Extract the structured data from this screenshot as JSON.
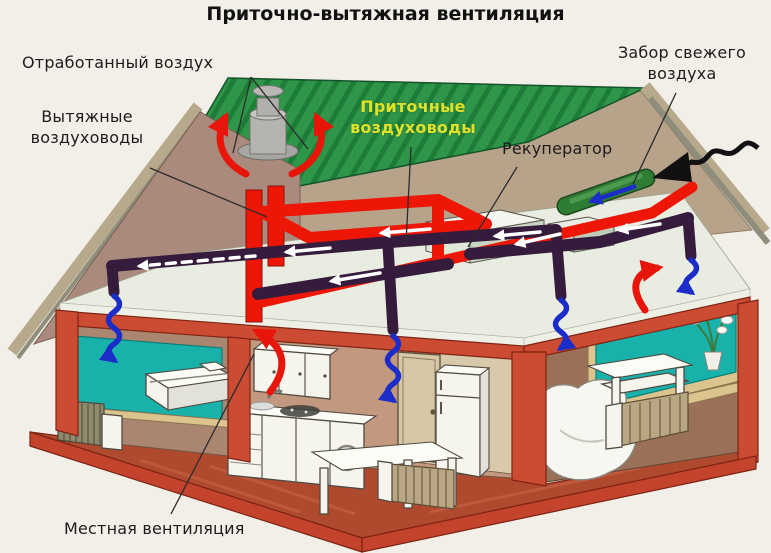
{
  "title": "Приточно-вытяжная вентиляция",
  "labels": {
    "exhaust_air": "Отработанный воздух",
    "exhaust_ducts": "Вытяжные воздуховоды",
    "supply_ducts": "Приточные воздуховоды",
    "recuperator": "Рекуператор",
    "fresh_air_intake": "Забор свежего воздуха",
    "local_ventilation": "Местная вентиляция"
  },
  "colors": {
    "background": "#f2efe8",
    "roof_green": "#2f9549",
    "roof_stripe": "#1e7c39",
    "duct_exhaust_red": "#ee1607",
    "duct_supply_dark": "#351b3c",
    "frame_red": "#cc4b33",
    "floor_red": "#b04a2e",
    "window_teal": "#18b2ab",
    "wall_brown": "#aa8570",
    "gable_mauve": "#a98a7c",
    "attic_tan": "#b7a28a",
    "ceiling_light": "#e9ece0",
    "arrow_blue": "#1b2cc8",
    "arrow_red": "#e8150b",
    "label_supply_yellow": "#dfe22b",
    "label_text": "#1c1c1c",
    "intake_green": "#2e7d33"
  }
}
